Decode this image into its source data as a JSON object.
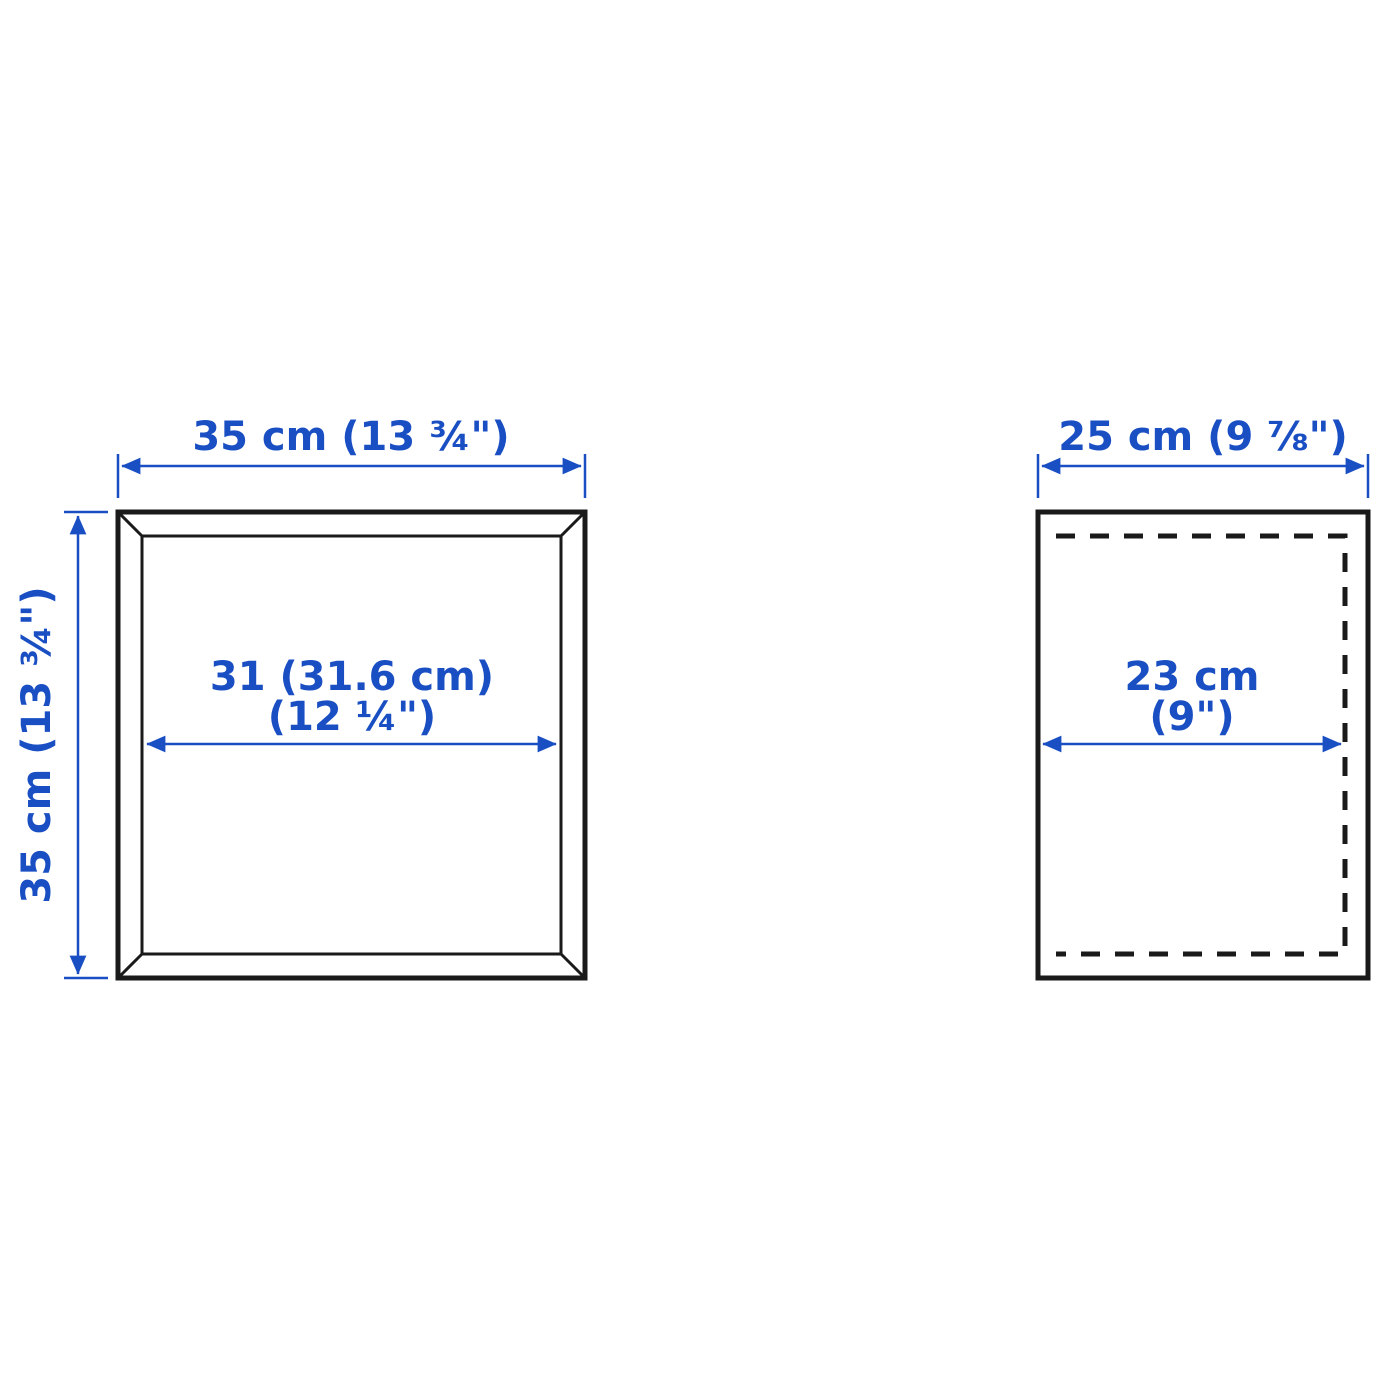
{
  "colors": {
    "accent": "#1a4fc4",
    "ink": "#1a1a1a",
    "background": "#ffffff"
  },
  "front_view": {
    "width_label": "35 cm (13 ¾\")",
    "height_label": "35 cm (13 ¾\")",
    "inner_width_label_line1": "31 (31.6 cm)",
    "inner_width_label_line2": "(12 ¼\")"
  },
  "side_view": {
    "width_label": "25 cm (9 ⅞\")",
    "inner_depth_label_line1": "23 cm",
    "inner_depth_label_line2": "(9\")"
  }
}
